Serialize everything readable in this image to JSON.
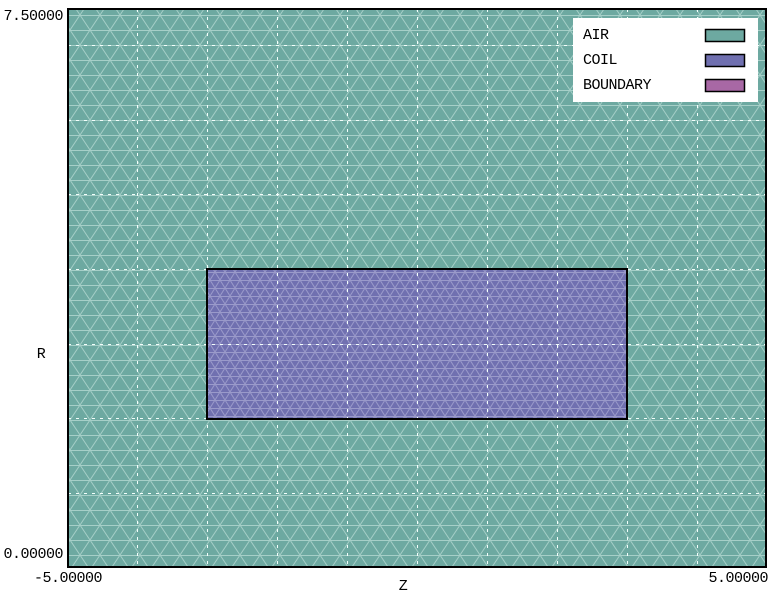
{
  "figure": {
    "y_axis": {
      "label": "R",
      "max_tick": "7.50000",
      "min_tick": "0.00000"
    },
    "x_axis": {
      "label": "Z",
      "min_tick": "-5.00000",
      "max_tick": "5.00000"
    },
    "legend": {
      "items": [
        {
          "label": "AIR",
          "fill": "#6DA9A1"
        },
        {
          "label": "COIL",
          "fill": "#7070B0"
        },
        {
          "label": "BOUNDARY",
          "fill": "#A868A5"
        }
      ]
    }
  },
  "colors": {
    "air_mesh_line": "#A6CFC8",
    "coil_mesh_line": "#9A9ACA",
    "grid_line": "#F4FFFC",
    "border": "#000000",
    "page_background": "#FFFFFF"
  },
  "chart_data": {
    "type": "mesh",
    "description": "2D axisymmetric finite-element triangular mesh plot: rectangular COIL region embedded in AIR domain",
    "xlabel": "Z",
    "ylabel": "R",
    "xlim": [
      -5,
      5
    ],
    "ylim": [
      0,
      7.5
    ],
    "x_tick_labels": [
      "-5.00000",
      "5.00000"
    ],
    "y_tick_labels": [
      "0.00000",
      "7.50000"
    ],
    "grid": {
      "shown": true,
      "style": "dashed-white",
      "x_step": 1,
      "y_step": 1
    },
    "legend": {
      "position": "top-right",
      "entries": [
        "AIR",
        "COIL",
        "BOUNDARY"
      ]
    },
    "regions": [
      {
        "name": "AIR",
        "fill": "#6DA9A1",
        "mesh_line": "#A6CFC8",
        "z_extent": [
          -5,
          5
        ],
        "r_extent": [
          0,
          7.5
        ],
        "mesh_density": "coarse"
      },
      {
        "name": "COIL",
        "fill": "#7070B0",
        "mesh_line": "#9A9ACA",
        "z_extent": [
          -3,
          3
        ],
        "r_extent": [
          2,
          4
        ],
        "mesh_density": "fine"
      },
      {
        "name": "BOUNDARY",
        "fill": "#A868A5"
      }
    ]
  }
}
